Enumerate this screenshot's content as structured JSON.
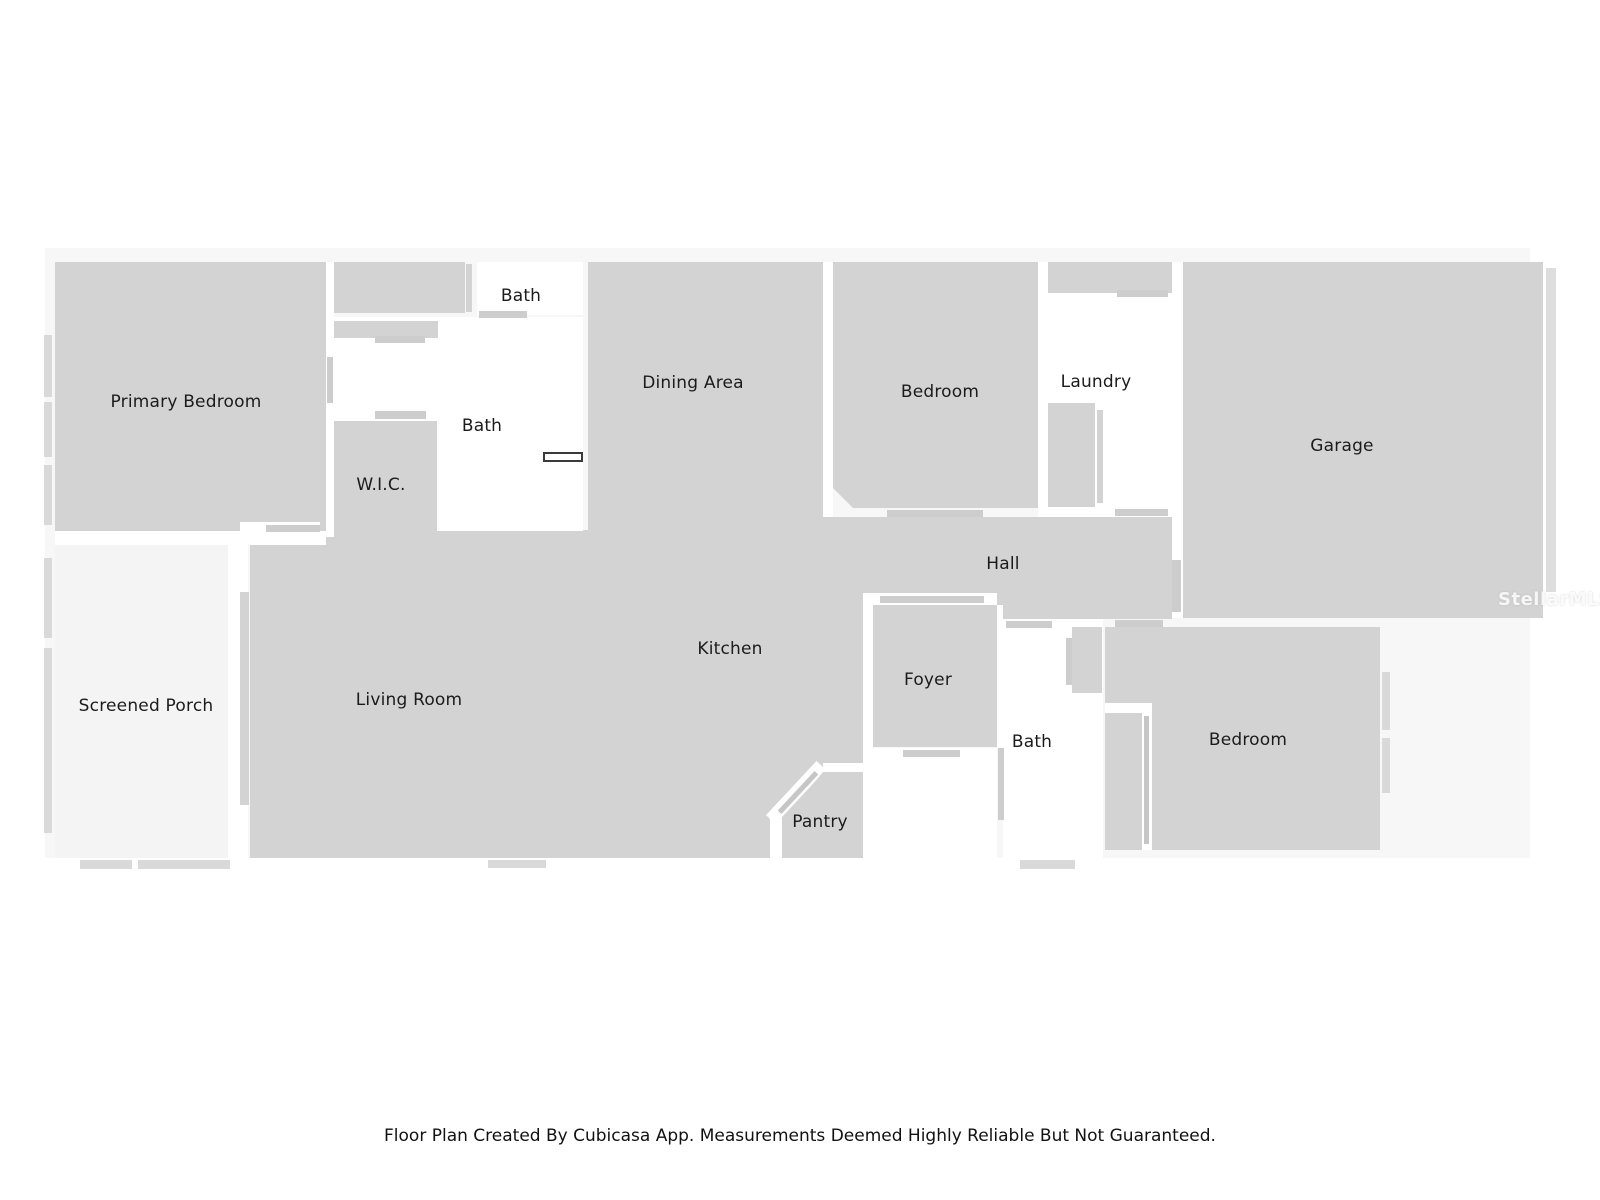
{
  "colors": {
    "room": "#d3d3d3",
    "marker": "#cdcdcd",
    "markerDark": "#c6c6c6",
    "window": "#d9d9d9",
    "white": "#ffffff",
    "backdrop": "#f7f7f7",
    "porch": "#f4f4f4",
    "strip": "#dddddd",
    "labelText": "#1b1b1b"
  },
  "shapes": [
    {
      "name": "plan-backdrop",
      "x": 45,
      "y": 248,
      "w": 1485,
      "h": 610,
      "fill": "backdrop"
    },
    {
      "name": "screened-porch-floor",
      "x": 55,
      "y": 545,
      "w": 173,
      "h": 313,
      "fill": "porch"
    },
    {
      "name": "primary-bedroom-floor",
      "x": 55,
      "y": 262,
      "w": 271,
      "h": 269,
      "fill": "room"
    },
    {
      "name": "primary-closet-floor",
      "x": 334,
      "y": 262,
      "w": 131,
      "h": 51,
      "fill": "room"
    },
    {
      "name": "closet-side-wall",
      "x": 466,
      "y": 264,
      "w": 6,
      "h": 48,
      "fill": "room"
    },
    {
      "name": "dining-area-floor",
      "x": 588,
      "y": 262,
      "w": 235,
      "h": 268,
      "fill": "room"
    },
    {
      "name": "living-kitchen-floor",
      "x": 250,
      "y": 530,
      "w": 613,
      "h": 328,
      "fill": "room"
    },
    {
      "name": "bedroom-top-floor",
      "x": 833,
      "y": 262,
      "w": 205,
      "h": 246,
      "fill": "room",
      "clip": "polygon(0 0, 100% 0, 100% 100%, 20px 100%, 0 calc(100% - 20px))"
    },
    {
      "name": "hall-floor",
      "x": 823,
      "y": 517,
      "w": 349,
      "h": 102,
      "fill": "room"
    },
    {
      "name": "garage-floor",
      "x": 1183,
      "y": 262,
      "w": 360,
      "h": 356,
      "fill": "room"
    },
    {
      "name": "garage-right-wall-strip",
      "x": 1546,
      "y": 268,
      "w": 10,
      "h": 324,
      "fill": "strip"
    },
    {
      "name": "laundry-closet-floor",
      "x": 1048,
      "y": 262,
      "w": 124,
      "h": 31,
      "fill": "room"
    },
    {
      "name": "bedroom-bottom-floor",
      "x": 1105,
      "y": 627,
      "w": 275,
      "h": 223,
      "fill": "room"
    },
    {
      "name": "bath-top-floor",
      "x": 477,
      "y": 262,
      "w": 106,
      "h": 53,
      "fill": "white"
    },
    {
      "name": "bath-mid-floor",
      "x": 333,
      "y": 317,
      "w": 250,
      "h": 214,
      "fill": "white"
    },
    {
      "name": "wall-gap-primary-right",
      "x": 326,
      "y": 262,
      "w": 8,
      "h": 275,
      "fill": "white"
    },
    {
      "name": "wall-gap-primary-porch",
      "x": 55,
      "y": 531,
      "w": 271,
      "h": 14,
      "fill": "white"
    },
    {
      "name": "wall-gap-porch-living",
      "x": 228,
      "y": 537,
      "w": 20,
      "h": 321,
      "fill": "white"
    },
    {
      "name": "wall-gap-dining-bedroom",
      "x": 823,
      "y": 262,
      "w": 10,
      "h": 255,
      "fill": "white"
    },
    {
      "name": "wall-gap-bedroom-laundry",
      "x": 1038,
      "y": 262,
      "w": 10,
      "h": 255,
      "fill": "white"
    },
    {
      "name": "laundry-floor",
      "x": 1048,
      "y": 293,
      "w": 124,
      "h": 224,
      "fill": "white"
    },
    {
      "name": "wall-gap-garage",
      "x": 1172,
      "y": 262,
      "w": 11,
      "h": 356,
      "fill": "white"
    },
    {
      "name": "hall-foyer-opening",
      "x": 863,
      "y": 593,
      "w": 134,
      "h": 14,
      "fill": "white"
    },
    {
      "name": "wall-gap-kitchen-foyer",
      "x": 863,
      "y": 605,
      "w": 10,
      "h": 143,
      "fill": "white"
    },
    {
      "name": "entry-floor",
      "x": 863,
      "y": 748,
      "w": 134,
      "h": 110,
      "fill": "white"
    },
    {
      "name": "wall-gap-foyer-bath",
      "x": 997,
      "y": 605,
      "w": 6,
      "h": 143,
      "fill": "white"
    },
    {
      "name": "bath-bottom-floor",
      "x": 1003,
      "y": 619,
      "w": 100,
      "h": 239,
      "fill": "white"
    },
    {
      "name": "pantry-door-opening",
      "x": 759,
      "y": 786,
      "w": 74,
      "h": 13,
      "fill": "white",
      "rot": -47
    },
    {
      "name": "pantry-top-wall-gap",
      "x": 823,
      "y": 763,
      "w": 40,
      "h": 9,
      "fill": "white"
    },
    {
      "name": "pantry-left-wall-gap",
      "x": 770,
      "y": 816,
      "w": 12,
      "h": 42,
      "fill": "white"
    },
    {
      "name": "primary-door-opening",
      "x": 240,
      "y": 522,
      "w": 80,
      "h": 11,
      "fill": "white"
    },
    {
      "name": "bedroom-bottom-notch-h",
      "x": 1105,
      "y": 703,
      "w": 47,
      "h": 10,
      "fill": "white"
    },
    {
      "name": "bedroom-bottom-notch-v",
      "x": 1142,
      "y": 703,
      "w": 10,
      "h": 147,
      "fill": "white"
    },
    {
      "name": "bath-vanity",
      "x": 334,
      "y": 321,
      "w": 104,
      "h": 17,
      "fill": "room"
    },
    {
      "name": "wic-floor",
      "x": 334,
      "y": 421,
      "w": 103,
      "h": 116,
      "fill": "room"
    },
    {
      "name": "washer-dryer",
      "x": 1048,
      "y": 403,
      "w": 47,
      "h": 104,
      "fill": "room"
    },
    {
      "name": "washer-side-bar",
      "x": 1097,
      "y": 410,
      "w": 6,
      "h": 93,
      "fill": "room"
    },
    {
      "name": "foyer-floor",
      "x": 873,
      "y": 605,
      "w": 124,
      "h": 142,
      "fill": "room"
    },
    {
      "name": "pantry-floor",
      "x": 782,
      "y": 772,
      "w": 81,
      "h": 86,
      "fill": "room",
      "clip": "polygon(41px 0, 100% 0, 100% 100%, 0 100%, 0 50px)"
    },
    {
      "name": "bath-bottom-closet",
      "x": 1072,
      "y": 627,
      "w": 30,
      "h": 66,
      "fill": "room"
    },
    {
      "name": "bath-bottom-closet-bar",
      "x": 1066,
      "y": 638,
      "w": 6,
      "h": 47,
      "fill": "marker"
    },
    {
      "name": "primary-door-bar",
      "x": 266,
      "y": 525,
      "w": 54,
      "h": 7,
      "fill": "marker"
    },
    {
      "name": "closet-door-bar",
      "x": 479,
      "y": 311,
      "w": 48,
      "h": 7,
      "fill": "marker"
    },
    {
      "name": "bath-divider-door-bar",
      "x": 375,
      "y": 336,
      "w": 50,
      "h": 7,
      "fill": "marker"
    },
    {
      "name": "wic-door-bar",
      "x": 375,
      "y": 411,
      "w": 51,
      "h": 8,
      "fill": "marker"
    },
    {
      "name": "bath-wall-bar",
      "x": 327,
      "y": 357,
      "w": 6,
      "h": 46,
      "fill": "marker"
    },
    {
      "name": "bedroom-top-door-bar",
      "x": 887,
      "y": 510,
      "w": 96,
      "h": 7,
      "fill": "marker"
    },
    {
      "name": "laundry-top-door-bar",
      "x": 1117,
      "y": 290,
      "w": 51,
      "h": 7,
      "fill": "marker"
    },
    {
      "name": "laundry-bottom-door-bar",
      "x": 1115,
      "y": 509,
      "w": 53,
      "h": 7,
      "fill": "marker"
    },
    {
      "name": "garage-hall-door-bar",
      "x": 1172,
      "y": 560,
      "w": 9,
      "h": 52,
      "fill": "marker"
    },
    {
      "name": "foyer-top-door-bar",
      "x": 880,
      "y": 596,
      "w": 104,
      "h": 7,
      "fill": "marker"
    },
    {
      "name": "foyer-bottom-door-bar",
      "x": 903,
      "y": 750,
      "w": 57,
      "h": 7,
      "fill": "marker"
    },
    {
      "name": "hall-bath-door-bar",
      "x": 1006,
      "y": 621,
      "w": 46,
      "h": 7,
      "fill": "marker"
    },
    {
      "name": "hall-bedroom-door-bar",
      "x": 1115,
      "y": 620,
      "w": 48,
      "h": 7,
      "fill": "marker"
    },
    {
      "name": "entry-wall-bar",
      "x": 998,
      "y": 748,
      "w": 6,
      "h": 72,
      "fill": "marker"
    },
    {
      "name": "porch-living-wall-bar",
      "x": 240,
      "y": 592,
      "w": 9,
      "h": 213,
      "fill": "room"
    },
    {
      "name": "bedroom-slider-bar",
      "x": 1144,
      "y": 716,
      "w": 5,
      "h": 128,
      "fill": "markerDark"
    },
    {
      "name": "pantry-door-leaf",
      "x": 771,
      "y": 790,
      "w": 54,
      "h": 5,
      "fill": "markerDark",
      "rot": -47
    },
    {
      "name": "window-primary-left-1",
      "x": 44,
      "y": 335,
      "w": 8,
      "h": 62,
      "fill": "window"
    },
    {
      "name": "window-primary-left-2",
      "x": 44,
      "y": 402,
      "w": 8,
      "h": 55,
      "fill": "window"
    },
    {
      "name": "window-primary-left-3",
      "x": 44,
      "y": 465,
      "w": 8,
      "h": 60,
      "fill": "window"
    },
    {
      "name": "window-porch-left-1",
      "x": 44,
      "y": 558,
      "w": 8,
      "h": 80,
      "fill": "window"
    },
    {
      "name": "window-porch-left-2",
      "x": 44,
      "y": 648,
      "w": 8,
      "h": 185,
      "fill": "window"
    },
    {
      "name": "window-porch-bottom-1",
      "x": 80,
      "y": 860,
      "w": 52,
      "h": 9,
      "fill": "window"
    },
    {
      "name": "window-porch-bottom-2",
      "x": 138,
      "y": 860,
      "w": 92,
      "h": 9,
      "fill": "window"
    },
    {
      "name": "window-living-bottom",
      "x": 488,
      "y": 860,
      "w": 58,
      "h": 8,
      "fill": "window"
    },
    {
      "name": "window-bath-bottom",
      "x": 1020,
      "y": 860,
      "w": 55,
      "h": 9,
      "fill": "window"
    },
    {
      "name": "window-bedroom-right-1",
      "x": 1382,
      "y": 672,
      "w": 8,
      "h": 58,
      "fill": "window"
    },
    {
      "name": "window-bedroom-right-2",
      "x": 1382,
      "y": 738,
      "w": 8,
      "h": 55,
      "fill": "window"
    },
    {
      "name": "fixture-towel-bar",
      "x": 543,
      "y": 452,
      "w": 40,
      "h": 10,
      "fill": "white",
      "border": "2px solid #3a3a3a"
    }
  ],
  "labels": [
    {
      "id": "primary-bedroom",
      "text": "Primary Bedroom",
      "x": 186,
      "y": 402
    },
    {
      "id": "bath-top",
      "text": "Bath",
      "x": 521,
      "y": 296
    },
    {
      "id": "bath-mid",
      "text": "Bath",
      "x": 482,
      "y": 426
    },
    {
      "id": "wic",
      "text": "W.I.C.",
      "x": 381,
      "y": 485
    },
    {
      "id": "dining-area",
      "text": "Dining Area",
      "x": 693,
      "y": 383
    },
    {
      "id": "bedroom-top",
      "text": "Bedroom",
      "x": 940,
      "y": 392
    },
    {
      "id": "laundry",
      "text": "Laundry",
      "x": 1096,
      "y": 382
    },
    {
      "id": "garage",
      "text": "Garage",
      "x": 1342,
      "y": 446
    },
    {
      "id": "hall",
      "text": "Hall",
      "x": 1003,
      "y": 564
    },
    {
      "id": "screened-porch",
      "text": "Screened Porch",
      "x": 146,
      "y": 706
    },
    {
      "id": "living-room",
      "text": "Living Room",
      "x": 409,
      "y": 700
    },
    {
      "id": "kitchen",
      "text": "Kitchen",
      "x": 730,
      "y": 649
    },
    {
      "id": "foyer",
      "text": "Foyer",
      "x": 928,
      "y": 680
    },
    {
      "id": "bath-bottom",
      "text": "Bath",
      "x": 1032,
      "y": 742
    },
    {
      "id": "bedroom-bottom",
      "text": "Bedroom",
      "x": 1248,
      "y": 740
    },
    {
      "id": "pantry",
      "text": "Pantry",
      "x": 820,
      "y": 822
    }
  ],
  "watermark": {
    "text": "StellarMLS",
    "x": 1498,
    "y": 589
  },
  "footer": {
    "disclaimer": "Floor Plan Created By Cubicasa App. Measurements Deemed Highly Reliable But Not Guaranteed."
  }
}
